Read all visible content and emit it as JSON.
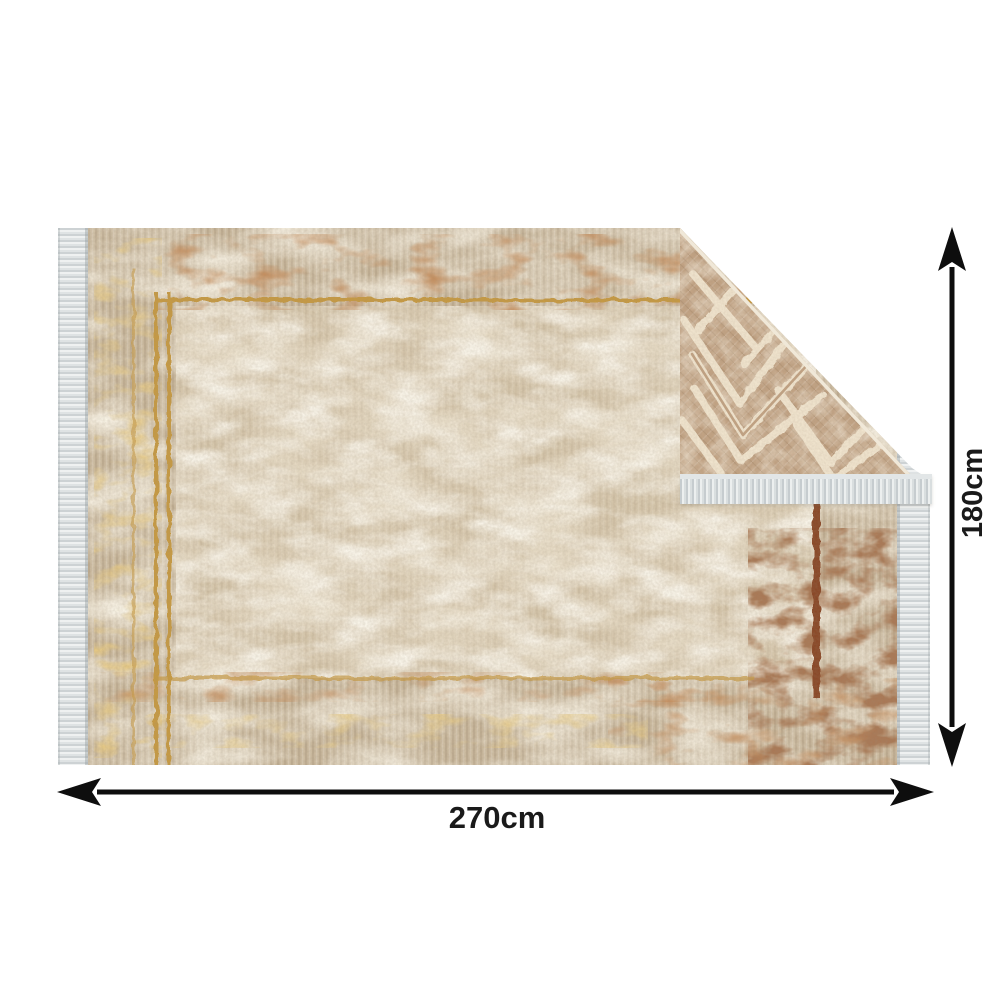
{
  "image_type": "rug-product-dimension-image",
  "background_color": "#ffffff",
  "dimension_annotations": {
    "width": {
      "label": "270cm"
    },
    "height": {
      "label": "180cm"
    },
    "arrow_color": "#0e0e0e",
    "label_color": "#1a1a1a"
  },
  "rug": {
    "front_side": {
      "style": "distressed-vintage-oriental",
      "base_color": "#cdbca1",
      "field_color": "#e3d6bc",
      "rust_color": "#8f4a1f",
      "dark_rust_color": "#663319",
      "gold_color": "#c79a42"
    },
    "back_side_fold": {
      "style": "geometric-chevron-diamond",
      "base_color": "#c2a384",
      "line_color": "#f2e6d0",
      "fold_corner": "top-right"
    },
    "fringe_color": "#e9ecec",
    "fringed_edges": "left-right-and-fold"
  }
}
